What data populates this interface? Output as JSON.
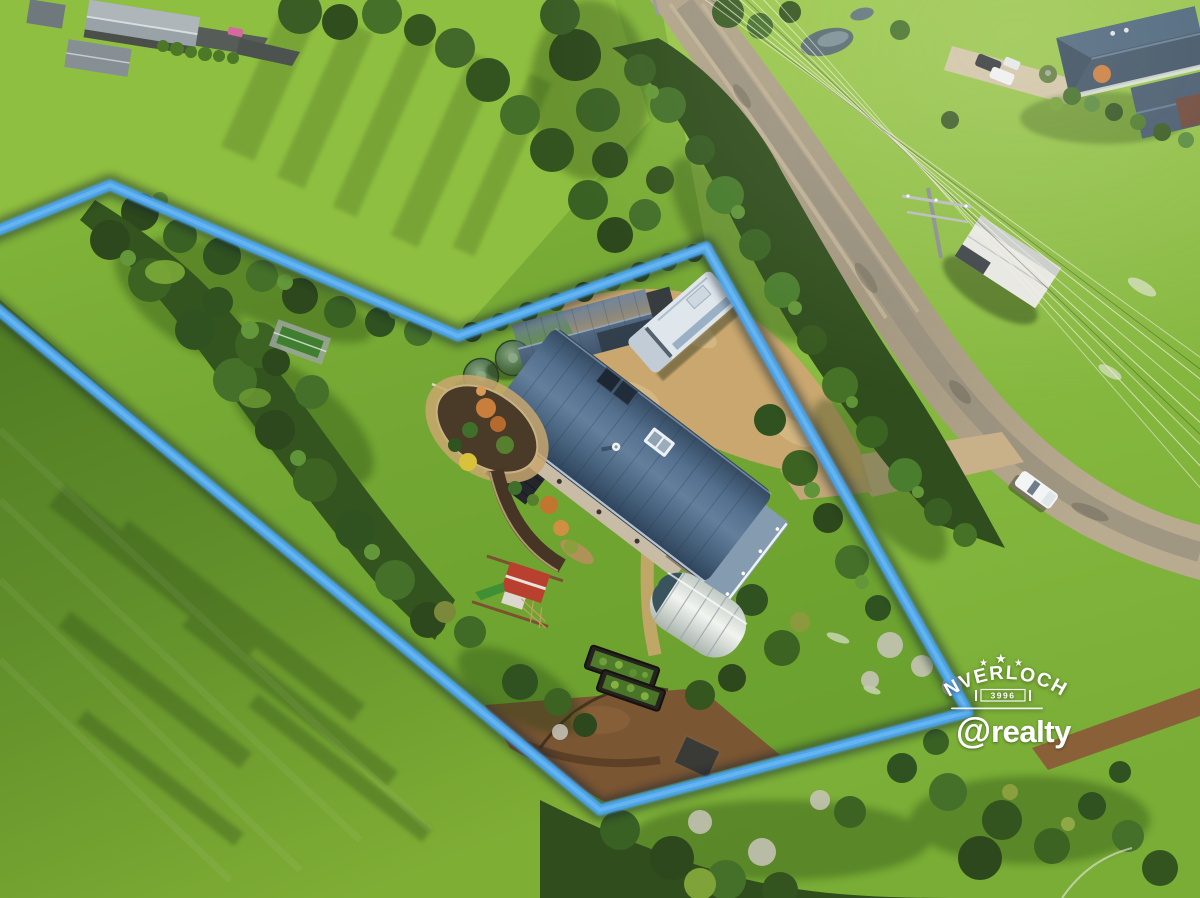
{
  "photo": {
    "kind": "aerial drone photograph of rural acreage property for sale",
    "width_px": 1200,
    "height_px": 898
  },
  "boundary": {
    "path": "M -16 236 L 110 185 L 458 336 L 706 247 L 968 712 L 600 810 L -16 298",
    "color": "#4BA5EC"
  },
  "watermarks": {
    "location_badge": {
      "star": "★",
      "name": "INVERLOCH",
      "postcode": "3996"
    },
    "agency_logo": {
      "at_symbol": "@",
      "brand": "realty"
    }
  },
  "colors": {
    "grass_bright": "#8CBE3F",
    "grass_shadow": "#3E6018",
    "tree_dark_green": "#2F4D1D",
    "road_gravel": "#A89A82",
    "driveway_dirt": "#C9A76E",
    "soil_brown": "#7A5633",
    "house_roof_blue": "#46627E",
    "shed_roof_blue": "#4A6585",
    "water_tank_green": "#3E5F3C",
    "greenhouse_white": "#E9ECE8",
    "boundary_blue": "#4BA5EC",
    "watermark_white": "#FFFFFF"
  }
}
